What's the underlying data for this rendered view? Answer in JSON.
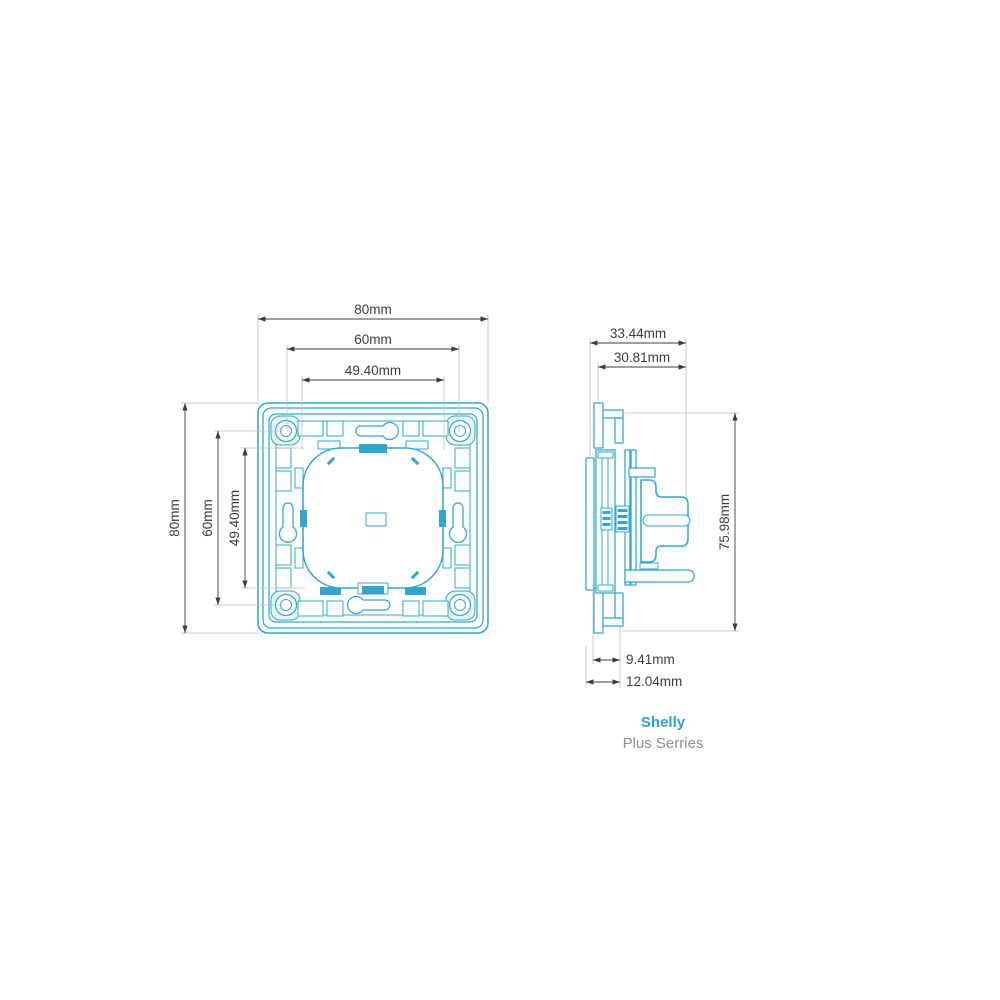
{
  "colors": {
    "outline": "#2fa8cd",
    "outline_fill_light": "#e7f4fa",
    "dimension_text": "#3d3d3d",
    "extension_line": "#bcbcbc",
    "brand_name": "#2aa4d7",
    "brand_series": "#8f8f8f"
  },
  "dims": {
    "front": {
      "width_outer": "80mm",
      "width_mid": "60mm",
      "width_inner": "49.40mm",
      "height_outer": "80mm",
      "height_mid": "60mm",
      "height_inner": "49.40mm"
    },
    "side": {
      "depth_outer": "33.44mm",
      "depth_inner": "30.81mm",
      "height": "75.98mm",
      "inset_inner": "9.41mm",
      "inset_outer": "12.04mm"
    }
  },
  "brand": {
    "name": "Shelly",
    "series": "Plus Serries"
  }
}
